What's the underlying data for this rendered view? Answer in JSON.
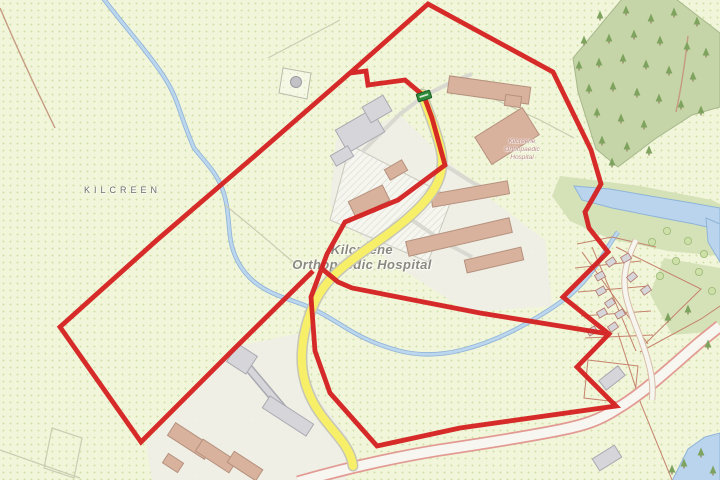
{
  "labels": {
    "townland": "KILCREEN",
    "hospital_main_line1": "Kilcreene",
    "hospital_main_line2": "Orthopaedic Hospital",
    "hospital_small_line1": "Kilcreene",
    "hospital_small_line2": "Orthopaedic",
    "hospital_small_line3": "Hospital"
  },
  "colors": {
    "boundary_red": "#d42020",
    "road_yellow": "#f8ef68",
    "water_blue": "#b9d4ec",
    "forest_green": "#c6d5a8",
    "field_background": "#f1f5d9",
    "marker_green": "#2f8b3b"
  }
}
